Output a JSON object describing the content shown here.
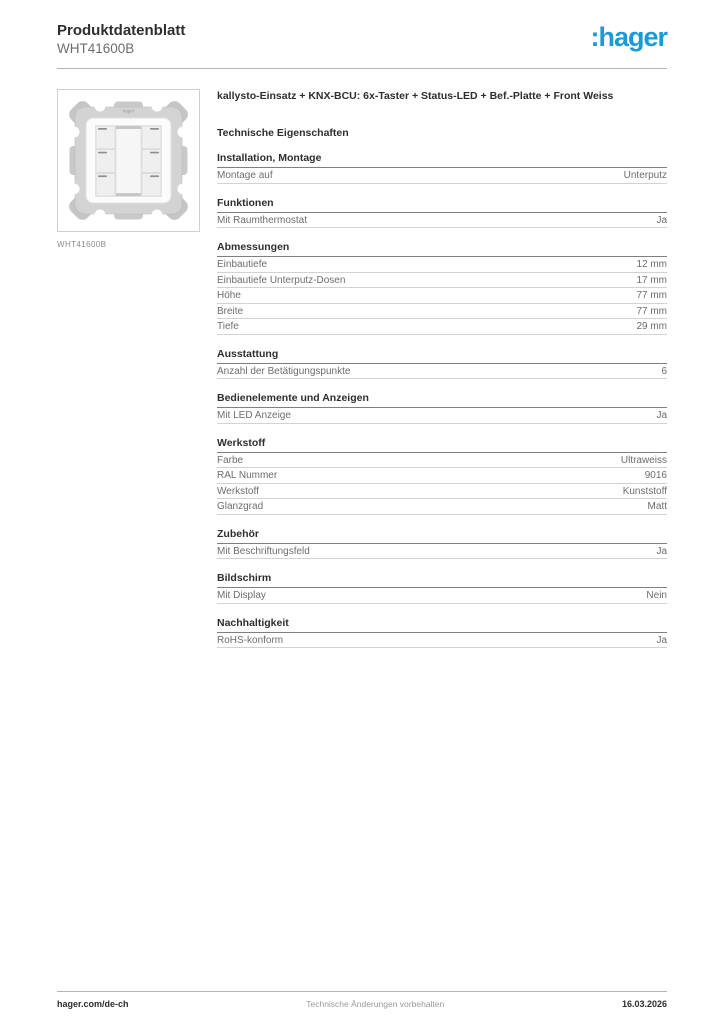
{
  "header": {
    "title": "Produktdatenblatt",
    "subtitle": "WHT41600B",
    "logo": ":hager"
  },
  "colors": {
    "brand_blue": "#1a9ad7",
    "heading_text": "#2e2e2e",
    "body_text": "#6d6d6d",
    "rule_light": "#d2d2d2",
    "rule_dark": "#7f7f7f"
  },
  "product": {
    "image_caption": "WHT41600B",
    "device_label": "hager",
    "title": "kallysto-Einsatz + KNX-BCU: 6x-Taster + Status-LED + Bef.-Platte + Front Weiss",
    "section_title": "Technische Eigenschaften"
  },
  "sections": [
    {
      "heading": "Installation, Montage",
      "rows": [
        {
          "label": "Montage auf",
          "value": "Unterputz"
        }
      ]
    },
    {
      "heading": "Funktionen",
      "rows": [
        {
          "label": "Mit Raumthermostat",
          "value": "Ja"
        }
      ]
    },
    {
      "heading": "Abmessungen",
      "rows": [
        {
          "label": "Einbautiefe",
          "value": "12 mm"
        },
        {
          "label": "Einbautiefe Unterputz-Dosen",
          "value": "17 mm"
        },
        {
          "label": "Höhe",
          "value": "77 mm"
        },
        {
          "label": "Breite",
          "value": "77 mm"
        },
        {
          "label": "Tiefe",
          "value": "29 mm"
        }
      ]
    },
    {
      "heading": "Ausstattung",
      "rows": [
        {
          "label": "Anzahl der Betätigungspunkte",
          "value": "6"
        }
      ]
    },
    {
      "heading": "Bedienelemente und Anzeigen",
      "rows": [
        {
          "label": "Mit LED Anzeige",
          "value": "Ja"
        }
      ]
    },
    {
      "heading": "Werkstoff",
      "rows": [
        {
          "label": "Farbe",
          "value": "Ultraweiss"
        },
        {
          "label": "RAL Nummer",
          "value": "9016"
        },
        {
          "label": "Werkstoff",
          "value": "Kunststoff"
        },
        {
          "label": "Glanzgrad",
          "value": "Matt"
        }
      ]
    },
    {
      "heading": "Zubehör",
      "rows": [
        {
          "label": "Mit Beschriftungsfeld",
          "value": "Ja"
        }
      ]
    },
    {
      "heading": "Bildschirm",
      "rows": [
        {
          "label": "Mit Display",
          "value": "Nein"
        }
      ]
    },
    {
      "heading": "Nachhaltigkeit",
      "rows": [
        {
          "label": "RoHS-konform",
          "value": "Ja"
        }
      ]
    }
  ],
  "footer": {
    "left": "hager.com/de-ch",
    "center": "Technische Änderungen vorbehalten",
    "right": "16.03.2026"
  }
}
